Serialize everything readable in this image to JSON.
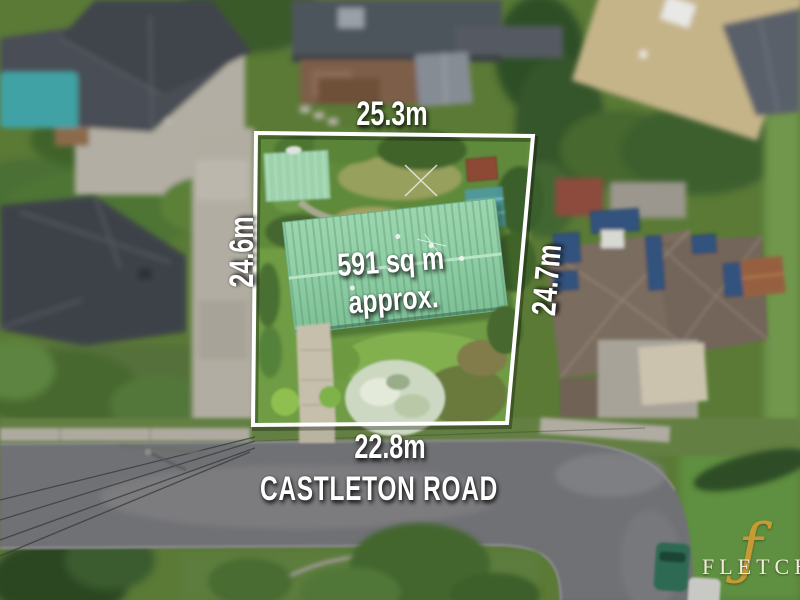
{
  "overlay": {
    "dim_top": "25.3m",
    "dim_left": "24.6m",
    "dim_right": "24.7m",
    "dim_bottom": "22.8m",
    "area_line1": "591 sq m",
    "area_line2": "approx.",
    "road_name": "CASTLETON ROAD",
    "label_color": "#ffffff",
    "boundary_color": "#ffffff"
  },
  "branding": {
    "agency_wordmark": "FLETCHERS",
    "monogram": "ƒ",
    "wordmark_color": "#f2ecda",
    "monogram_color": "#c79a33"
  },
  "photo": {
    "key_colors": {
      "main_roof_green": "#93cfa6",
      "lawn_green": "#75a446",
      "road_gray": "#707174",
      "pool_teal": "#3fa2a4",
      "solar_panel_blue": "#33527e",
      "neighbor_roof_dark": "#42474d",
      "neighbor_roof_tan": "#c6b489",
      "neighbor_roof_brown": "#7a6c5e"
    }
  }
}
